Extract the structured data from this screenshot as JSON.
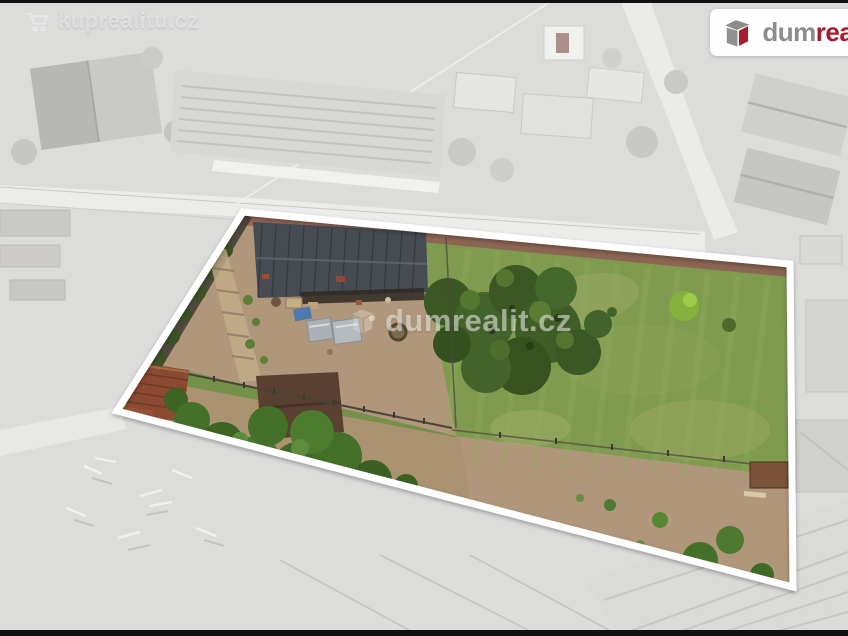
{
  "photo": {
    "kind": "aerial-drone-listing-photo",
    "alt": "Aerial view of a fenced building plot shown in color with a white outline, surrounding neighborhood desaturated to gray"
  },
  "watermarks": {
    "top_left": {
      "icon": "shopping-cart-icon",
      "text": "kuprealitu.cz"
    },
    "center": {
      "icon": "dumrealit-box-icon",
      "text": "dumrealit.cz"
    }
  },
  "brand_badge": {
    "icon": "dumrealit-box-icon",
    "text_gray": "dum",
    "text_red": "real",
    "clipped_at_right_edge": true
  },
  "colors": {
    "plot_outline": "#ffffff",
    "grass": "#7e9b50",
    "dirt": "#b0967a",
    "barn_roof": "#474c52",
    "tree_green": "#3a5724",
    "surroundings_gray": "#dcdcdb",
    "brand_gray": "#8c8c8c",
    "brand_red": "#a51c30",
    "frame_bar": "#111111"
  }
}
